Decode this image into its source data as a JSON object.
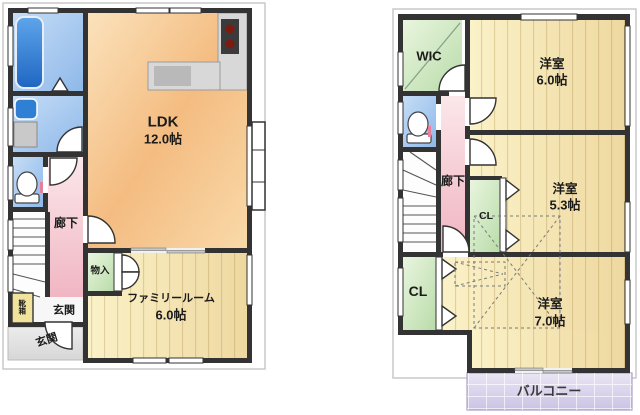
{
  "floor1": {
    "ldk": "LDK",
    "ldk_size": "12.0帖",
    "family_room": "ファミリールーム",
    "family_size": "6.0帖",
    "corridor": "廊下",
    "storage": "物入",
    "entrance_hall": "玄関",
    "entrance_porch": "玄関",
    "shoe_cabinet": "靴箱"
  },
  "floor2": {
    "wic": "WIC",
    "bedroom1": "洋室",
    "bedroom1_size": "6.0帖",
    "bedroom2": "洋室",
    "bedroom2_size": "5.3帖",
    "bedroom3": "洋室",
    "bedroom3_size": "7.0帖",
    "closet1": "CL",
    "closet2": "CL",
    "corridor": "廊下",
    "balcony": "バルコニー"
  },
  "colors": {
    "wall": "#333333",
    "ldk_floor": "#f6c28b",
    "wood_floor": "#f6e7b4",
    "corridor_pink": "#f5c9d1",
    "closet_green": "#cfe7c2",
    "wet_area_blue": "#a9c9f0",
    "balcony_purple": "#d9d2ec",
    "bathtub_blue": "#2e79d6",
    "stove_black": "#3b3b3b"
  }
}
